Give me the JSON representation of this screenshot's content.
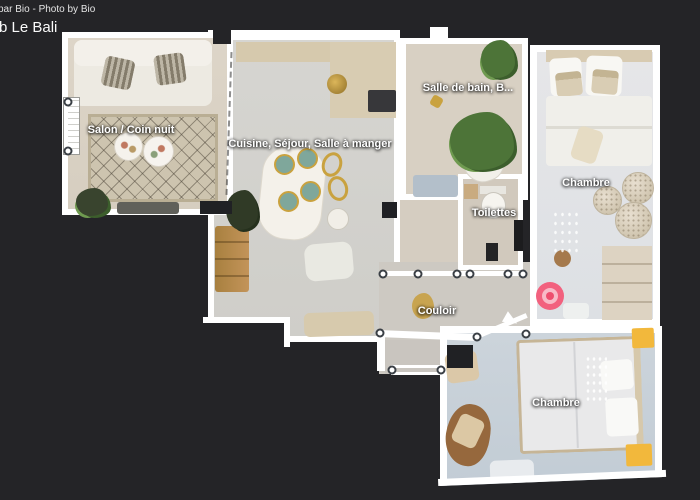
{
  "header": {
    "credit": "par Bio - Photo by Bio",
    "title": "b Le Bali"
  },
  "floorplan": {
    "rooms": {
      "salon": {
        "label": "Salon / Coin nuit"
      },
      "cuisine": {
        "label": "Cuisine, Séjour, Salle à manger"
      },
      "salle_de_bain": {
        "label": "Salle de bain, B..."
      },
      "chambre_droite": {
        "label": "Chambre"
      },
      "toilettes": {
        "label": "Toilettes"
      },
      "couloir": {
        "label": "Couloir"
      },
      "chambre_bas": {
        "label": "Chambre"
      }
    },
    "marker_colors": {
      "outer": "#f2617e",
      "ring": "#f8bac7",
      "dot": "#ee4e6e"
    },
    "background_color": "#242427",
    "wall_color": "#ffffff"
  }
}
